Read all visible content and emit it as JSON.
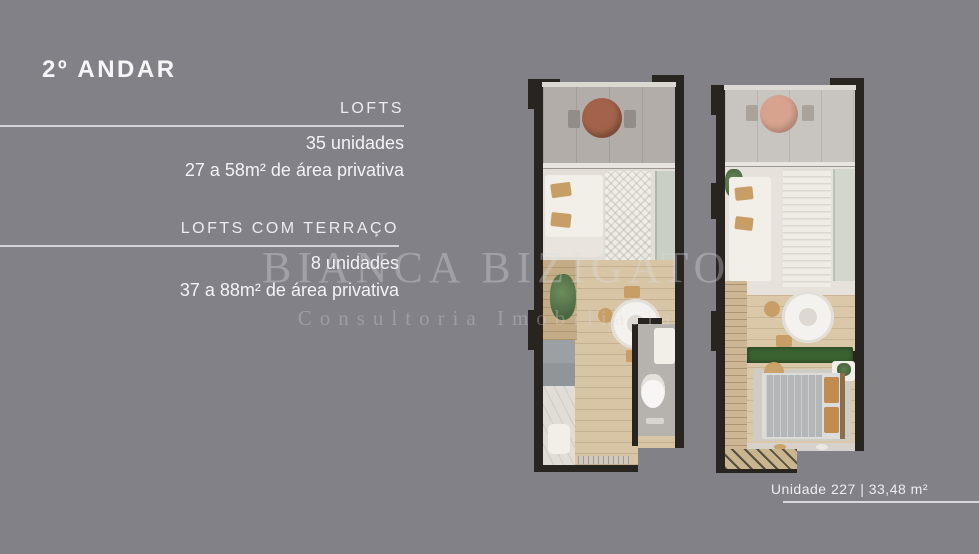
{
  "slide": {
    "title": "2º ANDAR",
    "sections": [
      {
        "label": "LOFTS",
        "line1": "35 unidades",
        "line2": "27 a 58m² de área privativa"
      },
      {
        "label": "LOFTS COM TERRAÇO",
        "line1": "8 unidades",
        "line2": "37 a 88m² de área privativa"
      }
    ],
    "watermark": {
      "name": "BIANCA BIZIGATO",
      "tagline": "Consultoria Imobiliária"
    },
    "unit_caption": "Unidade 227 | 33,48 m²"
  },
  "colors": {
    "background": "#828188",
    "wall": "#282420",
    "text": "#f3f2f5",
    "rule": "#dcdbe0",
    "wood_floor": "#d8c5a6",
    "balcony_concrete": "#b2ada8",
    "terracotta_table": "#a2634a",
    "blush_table": "#d7a38e",
    "sage_cabinet": "#c9d0c3",
    "hedge_green": "#3b6331",
    "pillow_tan": "#c79e66",
    "watermark": "rgba(219,219,226,0.34)"
  }
}
